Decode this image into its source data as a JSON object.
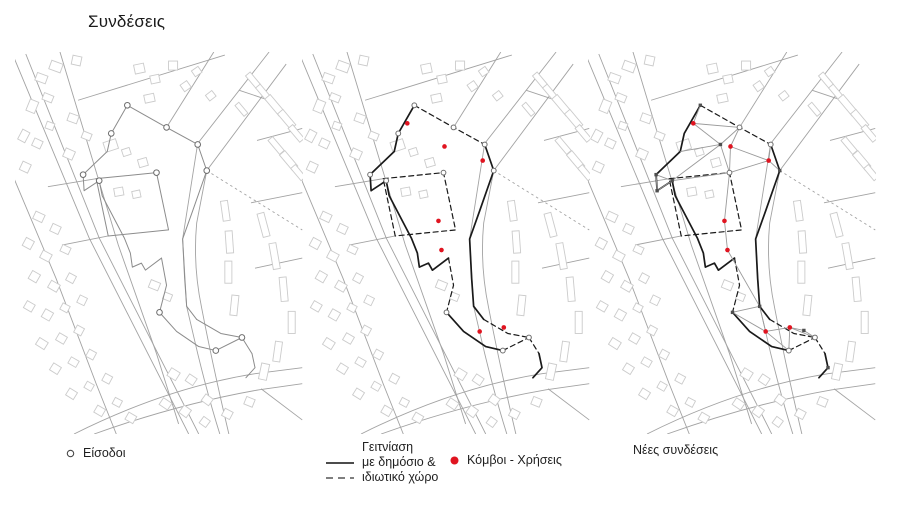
{
  "title": "Συνδέσεις",
  "colors": {
    "red": "#e01420",
    "boundary_black": "#1a1a1a",
    "boundary_gray": "#8c8c8c",
    "road": "#a3a3a3",
    "building": "#cbcbcb",
    "network": "#9a9a9a",
    "ring": "#6e6e6e",
    "square": "#4f4f4f",
    "text": "#1f1f1f"
  },
  "legends": {
    "entrances": {
      "symbol": "circle-outline",
      "label": "Είσοδοι"
    },
    "adjacency": {
      "rows": [
        {
          "symbol": "none",
          "label": "Γειτνίαση"
        },
        {
          "symbol": "solid-line",
          "label": "με δημόσιο &"
        },
        {
          "symbol": "dashed-line",
          "label": "ιδιωτικό χώρο"
        }
      ]
    },
    "nodes": {
      "symbol": "red-dot",
      "label": "Κόμβοι - Χρήσεις"
    },
    "connections": {
      "label": "Νέες συνδέσεις"
    }
  },
  "panels": [
    {
      "key": "entrances",
      "name": "map-panel-entrances"
    },
    {
      "key": "adjacency",
      "name": "map-panel-adjacency"
    },
    {
      "key": "connections",
      "name": "map-panel-new-connections"
    }
  ],
  "map": {
    "boundary_segments": [
      {
        "style": "solid",
        "pts": [
          [
            111,
            53
          ],
          [
            95,
            81
          ],
          [
            91,
            99
          ],
          [
            67,
            122
          ],
          [
            68,
            138
          ],
          [
            83,
            128
          ],
          [
            86,
            143
          ],
          [
            108,
            185
          ],
          [
            114,
            200
          ],
          [
            116,
            214
          ],
          [
            125,
            210
          ],
          [
            129,
            217
          ],
          [
            145,
            205
          ]
        ]
      },
      {
        "style": "dashed",
        "pts": [
          [
            145,
            205
          ],
          [
            150,
            232
          ],
          [
            143,
            259
          ]
        ]
      },
      {
        "style": "solid",
        "pts": [
          [
            143,
            259
          ],
          [
            160,
            278
          ],
          [
            182,
            293
          ],
          [
            199,
            297
          ]
        ]
      },
      {
        "style": "dashed",
        "pts": [
          [
            199,
            297
          ],
          [
            225,
            284
          ]
        ]
      },
      {
        "style": "dashed",
        "pts": [
          [
            111,
            53
          ],
          [
            150,
            75
          ],
          [
            181,
            92
          ]
        ]
      },
      {
        "style": "solid",
        "pts": [
          [
            181,
            92
          ],
          [
            190,
            118
          ],
          [
            176,
            158
          ],
          [
            166,
            186
          ],
          [
            168,
            225
          ],
          [
            170,
            253
          ],
          [
            180,
            266
          ]
        ]
      },
      {
        "style": "dashed",
        "pts": [
          [
            180,
            266
          ],
          [
            204,
            280
          ],
          [
            225,
            284
          ]
        ]
      },
      {
        "style": "dashed",
        "pts": [
          [
            225,
            284
          ],
          [
            235,
            300
          ]
        ]
      },
      {
        "style": "solid",
        "pts": [
          [
            235,
            300
          ],
          [
            238,
            314
          ],
          [
            229,
            324
          ]
        ]
      },
      {
        "style": "dashed",
        "pts": [
          [
            80,
            126
          ],
          [
            140,
            120
          ],
          [
            152,
            177
          ],
          [
            92,
            183
          ],
          [
            80,
            126
          ]
        ]
      }
    ],
    "entrances": [
      [
        111,
        53
      ],
      [
        150,
        75
      ],
      [
        181,
        92
      ],
      [
        190,
        118
      ],
      [
        95,
        81
      ],
      [
        67,
        122
      ],
      [
        83,
        128
      ],
      [
        140,
        120
      ],
      [
        143,
        259
      ],
      [
        199,
        297
      ],
      [
        225,
        284
      ]
    ],
    "rings_detail": [
      [
        111,
        53
      ],
      [
        150,
        75
      ],
      [
        181,
        92
      ],
      [
        190,
        118
      ],
      [
        95,
        81
      ],
      [
        140,
        120
      ],
      [
        67,
        122
      ],
      [
        83,
        128
      ],
      [
        143,
        259
      ],
      [
        199,
        297
      ],
      [
        225,
        284
      ]
    ],
    "rings_network": [
      [
        150,
        75
      ],
      [
        181,
        92
      ],
      [
        140,
        120
      ],
      [
        199,
        297
      ],
      [
        225,
        284
      ]
    ],
    "red_nodes": [
      [
        104,
        71
      ],
      [
        141,
        94
      ],
      [
        179,
        108
      ],
      [
        135,
        168
      ],
      [
        138,
        197
      ],
      [
        176,
        278
      ],
      [
        200,
        274
      ]
    ],
    "network": {
      "nodes": {
        "A": [
          111,
          53
        ],
        "B": [
          150,
          75
        ],
        "C": [
          181,
          92
        ],
        "D": [
          190,
          118
        ],
        "H": [
          131,
          92
        ],
        "L2": [
          91,
          99
        ],
        "L3": [
          67,
          122
        ],
        "L4": [
          83,
          128
        ],
        "N5": [
          68,
          138
        ],
        "Q2": [
          140,
          120
        ],
        "F": [
          170,
          253
        ],
        "M": [
          143,
          259
        ],
        "I": [
          199,
          297
        ],
        "J": [
          225,
          284
        ],
        "K": [
          238,
          314
        ],
        "P": [
          214,
          277
        ],
        "r1": [
          104,
          71
        ],
        "r2": [
          141,
          94
        ],
        "r3": [
          179,
          108
        ],
        "r4": [
          135,
          168
        ],
        "r5": [
          138,
          197
        ],
        "r6": [
          176,
          278
        ],
        "r7": [
          200,
          274
        ]
      },
      "edges": [
        [
          "A",
          "r1"
        ],
        [
          "r1",
          "B"
        ],
        [
          "r1",
          "H"
        ],
        [
          "B",
          "H"
        ],
        [
          "H",
          "L4"
        ],
        [
          "H",
          "Q2"
        ],
        [
          "H",
          "L2"
        ],
        [
          "B",
          "r2"
        ],
        [
          "r2",
          "r3"
        ],
        [
          "r2",
          "Q2"
        ],
        [
          "r3",
          "Q2"
        ],
        [
          "r3",
          "C"
        ],
        [
          "r3",
          "D"
        ],
        [
          "L3",
          "L4"
        ],
        [
          "L3",
          "N5"
        ],
        [
          "L4",
          "N5"
        ],
        [
          "L4",
          "Q2"
        ],
        [
          "Q2",
          "r4"
        ],
        [
          "r4",
          "r5"
        ],
        [
          "r5",
          "F"
        ],
        [
          "F",
          "M"
        ],
        [
          "M",
          "r6"
        ],
        [
          "F",
          "r6"
        ],
        [
          "r6",
          "r7"
        ],
        [
          "r6",
          "I"
        ],
        [
          "r7",
          "I"
        ],
        [
          "r7",
          "P"
        ],
        [
          "P",
          "J"
        ],
        [
          "r7",
          "J"
        ]
      ],
      "squares": [
        "A",
        "D",
        "L3",
        "L4",
        "N5",
        "H",
        "F",
        "M",
        "P",
        "K"
      ]
    }
  }
}
